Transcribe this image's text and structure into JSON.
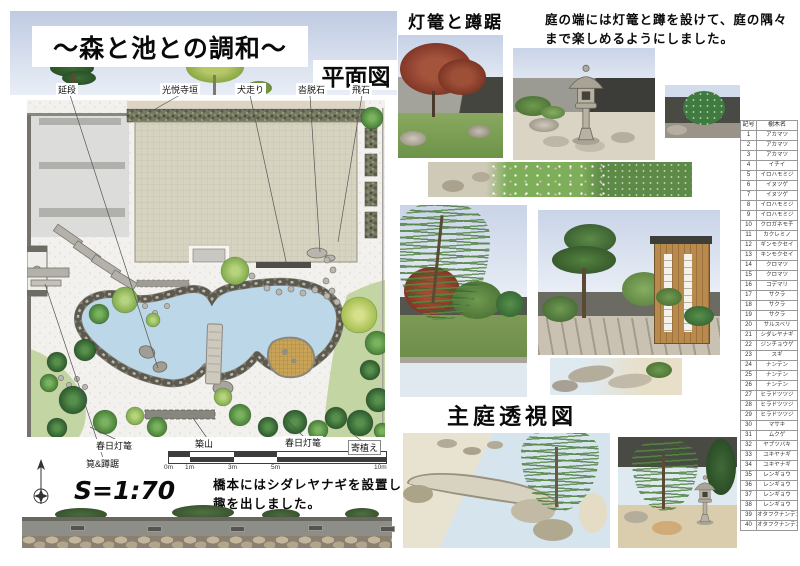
{
  "title": "〜森と池との調和〜",
  "plan_view_label": "平面図",
  "lantern_section_title": "灯篭と蹲踞",
  "perspective_section_title": "主庭透視図",
  "caption_top": {
    "line1": "庭の端には灯篭と蹲を設けて、庭の隅々",
    "line2": "まで楽しめるようにしました。"
  },
  "caption_bridge": {
    "line1": "橋本にはシダレヤナギを設置し",
    "line2": "趣を出しました。"
  },
  "scale_text": "S=1:70",
  "scalebar_labels": [
    "0m",
    "1m",
    "3m",
    "5m",
    "10m"
  ],
  "plan_labels": {
    "nobedan": "延段",
    "koetsuji_fence": "光悦寺垣",
    "inubashiri": "犬走り",
    "kutsunugi_ishi": "沓脱石",
    "tobiishi": "飛石",
    "kasuga_lantern_left": "春日灯篭",
    "kakei_tsukubai": "筧&蹲踞",
    "tsukiyama": "築山",
    "kasuga_lantern_right": "春日灯篭",
    "yoriue": "寄植え"
  },
  "plant_table": {
    "headers": [
      "記号",
      "樹木名"
    ],
    "rows": [
      [
        "1",
        "アカマツ"
      ],
      [
        "2",
        "アカマツ"
      ],
      [
        "3",
        "アカマツ"
      ],
      [
        "4",
        "イチイ"
      ],
      [
        "5",
        "イロハモミジ"
      ],
      [
        "6",
        "イヌツゲ"
      ],
      [
        "7",
        "イヌツゲ"
      ],
      [
        "8",
        "イロハモミジ"
      ],
      [
        "9",
        "イロハモミジ"
      ],
      [
        "10",
        "クロガネモチ"
      ],
      [
        "11",
        "カクレミノ"
      ],
      [
        "12",
        "ギンモクセイ"
      ],
      [
        "13",
        "キンモクセイ"
      ],
      [
        "14",
        "クロマツ"
      ],
      [
        "15",
        "クロマツ"
      ],
      [
        "16",
        "コデマリ"
      ],
      [
        "17",
        "サクラ"
      ],
      [
        "18",
        "サクラ"
      ],
      [
        "19",
        "サクラ"
      ],
      [
        "20",
        "サルスベリ"
      ],
      [
        "21",
        "シダレヤナギ"
      ],
      [
        "22",
        "ジンチョウゲ"
      ],
      [
        "23",
        "スギ"
      ],
      [
        "24",
        "ナンテン"
      ],
      [
        "25",
        "ナンテン"
      ],
      [
        "26",
        "ナンテン"
      ],
      [
        "27",
        "ヒラドツツジ"
      ],
      [
        "28",
        "ヒラドツツジ"
      ],
      [
        "29",
        "ヒラドツツジ"
      ],
      [
        "30",
        "マサキ"
      ],
      [
        "31",
        "ムクゲ"
      ],
      [
        "32",
        "ヤブツバキ"
      ],
      [
        "33",
        "ユキヤナギ"
      ],
      [
        "34",
        "ユキヤナギ"
      ],
      [
        "35",
        "レンギョウ"
      ],
      [
        "36",
        "レンギョウ"
      ],
      [
        "37",
        "レンギョウ"
      ],
      [
        "38",
        "レンギョウ"
      ],
      [
        "39",
        "オタフクナンテン"
      ],
      [
        "40",
        "オタフクナンテン"
      ]
    ]
  },
  "colors": {
    "sky": "#ccd6e8",
    "pond": "#bcd7e8",
    "building": "#d6d2c0",
    "foliage_dark": "#2d5a2d",
    "foliage_light": "#7fa94b",
    "wall_gray": "#8e8e88"
  }
}
